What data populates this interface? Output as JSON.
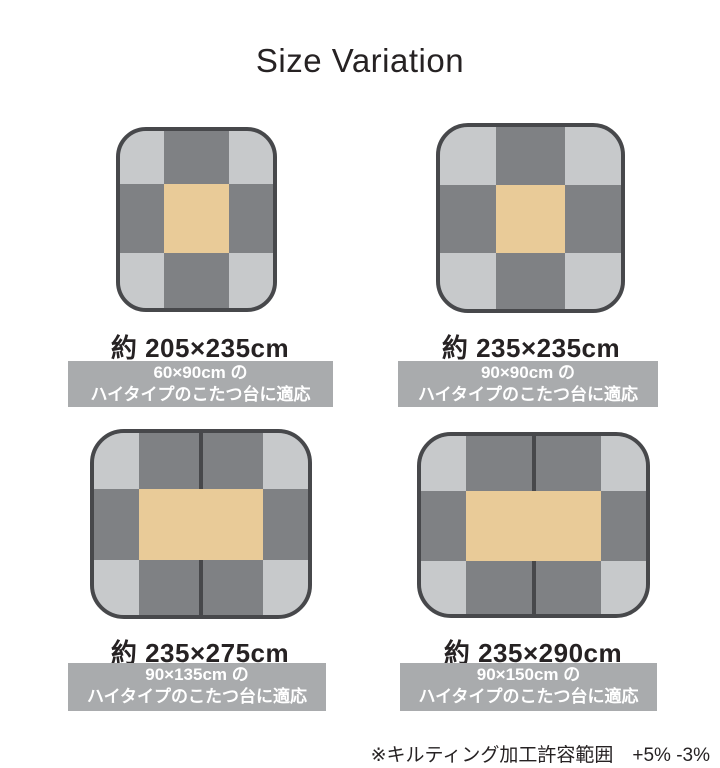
{
  "title": "Size Variation",
  "footnote": "※キルティング加工許容範囲　+5% -3%",
  "colors": {
    "page_bg": "#ffffff",
    "text": "#262223",
    "banner_bg": "#a9abad",
    "banner_text": "#ffffff",
    "rug_dark": "#7f8184",
    "rug_light": "#c7c9cb",
    "rug_center": "#e9cb98",
    "rug_border": "#47484b"
  },
  "variations": [
    {
      "size_label": "約 205×235cm",
      "banner_line1": "60×90cm の",
      "banner_line2": "ハイタイプのこたつ台に適応"
    },
    {
      "size_label": "約 235×235cm",
      "banner_line1": "90×90cm の",
      "banner_line2": "ハイタイプのこたつ台に適応"
    },
    {
      "size_label": "約 235×275cm",
      "banner_line1": "90×135cm の",
      "banner_line2": "ハイタイプのこたつ台に適応"
    },
    {
      "size_label": "約 235×290cm",
      "banner_line1": "90×150cm の",
      "banner_line2": "ハイタイプのこたつ台に適応"
    }
  ]
}
